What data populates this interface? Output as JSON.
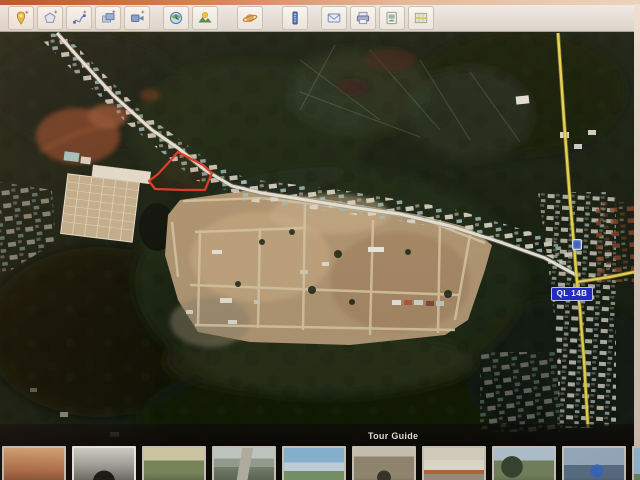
{
  "toolbar": {
    "icons": [
      {
        "name": "add-placemark-icon"
      },
      {
        "name": "add-polygon-icon"
      },
      {
        "name": "add-path-icon"
      },
      {
        "name": "add-image-overlay-icon"
      },
      {
        "name": "record-tour-icon"
      },
      {
        "name": "historical-imagery-icon"
      },
      {
        "name": "sunlight-icon"
      },
      {
        "name": "planets-icon"
      },
      {
        "name": "ruler-icon"
      },
      {
        "name": "email-icon"
      },
      {
        "name": "print-icon"
      },
      {
        "name": "save-image-icon"
      },
      {
        "name": "view-in-maps-icon"
      }
    ]
  },
  "map": {
    "road_badge_label": "QL 14B",
    "colors": {
      "highway_line": "#ecd84e",
      "main_road_line": "#ece8dc",
      "parcel_outline": "#e83524",
      "road_badge_bg": "#202ad0",
      "road_badge_text": "#ffffff",
      "road_marker": "#3a66cc",
      "vegetation_dark": "#141d0e",
      "cleared_land": "#b49872",
      "red_soil": "#7c3c20"
    }
  },
  "tour_guide": {
    "title": "Tour Guide",
    "thumbnails": [
      {
        "name": "city-panorama"
      },
      {
        "name": "tunnel-bw-photo"
      },
      {
        "name": "palm-town-view"
      },
      {
        "name": "bridge-road"
      },
      {
        "name": "coastal-view"
      },
      {
        "name": "temple-gate"
      },
      {
        "name": "colonnade-building"
      },
      {
        "name": "street-trees"
      },
      {
        "name": "riverside-figure"
      },
      {
        "name": "white-tower"
      }
    ]
  }
}
